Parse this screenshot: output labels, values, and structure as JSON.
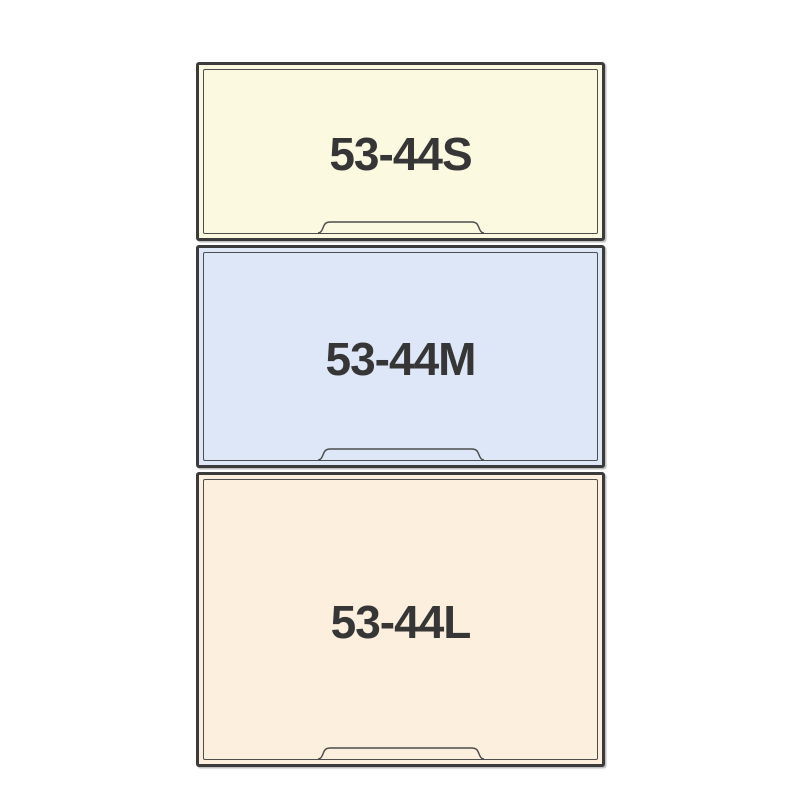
{
  "page": {
    "background_color": "#ffffff"
  },
  "colors": {
    "outer_border": "#3b3b3b",
    "inner_border": "#4d4d4d",
    "label_text": "#363636"
  },
  "drawers": [
    {
      "label": "53-44S",
      "fill": "#fbf9e0"
    },
    {
      "label": "53-44M",
      "fill": "#dde7f7"
    },
    {
      "label": "53-44L",
      "fill": "#fdefdd"
    }
  ]
}
